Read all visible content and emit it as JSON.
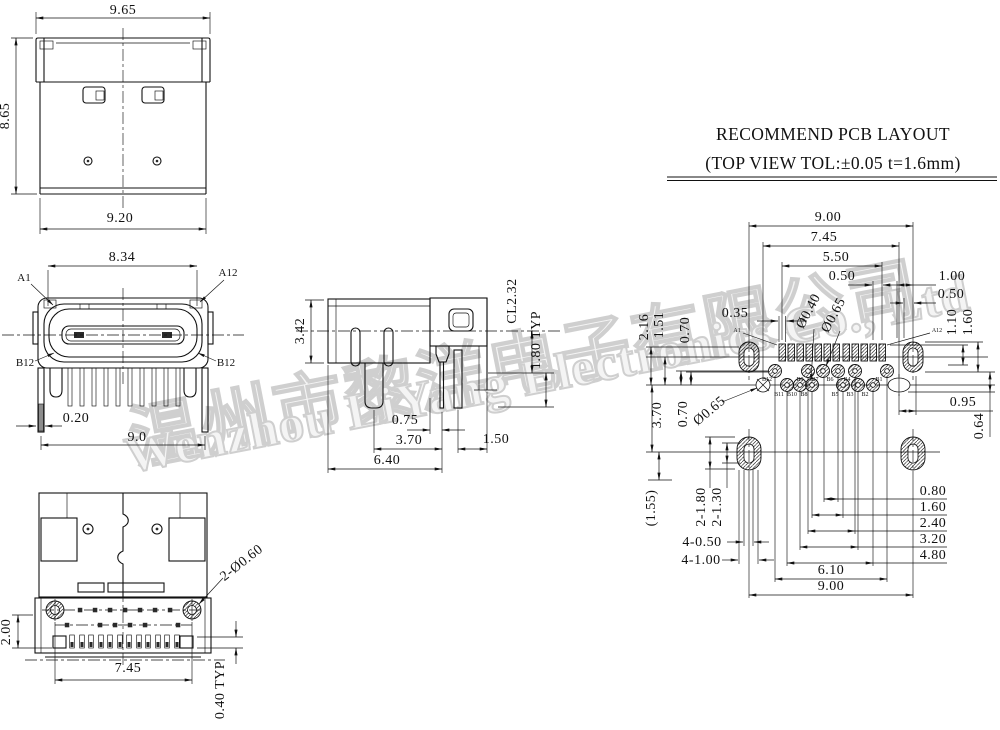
{
  "colors": {
    "line": "#111111",
    "watermark_stroke": "#cfcfcf"
  },
  "watermark": {
    "line1": "温州市黎洋电子有限公司",
    "line2": "Wenzhou LiYang Electronics Co., Ltd"
  },
  "pcb_title": {
    "line1": "RECOMMEND PCB LAYOUT",
    "line2": "(TOP VIEW TOL:±0.05 t=1.6mm)"
  },
  "top_view": {
    "width_top": "9.65",
    "height_left": "8.65",
    "width_bottom": "9.20"
  },
  "front_view": {
    "tongue_width": "8.34",
    "label_a1": "A1",
    "label_a12": "A12",
    "label_b12_left": "B12",
    "label_b12_right": "B12",
    "lead_thickness": "0.20",
    "body_width": "9.0"
  },
  "side_view": {
    "body_height": "3.42",
    "centerline_offset": "CL2.32",
    "lead_pitch": "1.80 TYP",
    "pin_offset": "0.75",
    "mid_span": "3.70",
    "tail_gap": "1.50",
    "overall_depth": "6.40"
  },
  "bottom_view": {
    "hole_callout": "2-Ø0.60",
    "flange_height": "2.00",
    "screw_span": "7.45",
    "pad_pitch": "0.40 TYP"
  },
  "pcb_layout": {
    "span_900_top": "9.00",
    "span_745": "7.45",
    "span_550": "5.50",
    "pad_pitch": "0.50",
    "right_100": "1.00",
    "right_050": "0.50",
    "left_216": "2.16",
    "left_151": "1.51",
    "left_070": "0.70",
    "pad_width": "0.35",
    "via_dia": "Ø0.40",
    "hole_dia": "Ø0.65",
    "label_a1": "A1",
    "label_a12": "A12",
    "right_110": "1.10",
    "right_160": "1.60",
    "mid_095": "0.95",
    "right_064": "0.64",
    "left_370": "3.70",
    "left_070b": "0.70",
    "hole_dia_b": "Ø0.65",
    "ref_155": "(1.55)",
    "slot_180": "2-1.80",
    "slot_130": "2-1.30",
    "slot_width": "4-0.50",
    "slot_height": "4-1.00",
    "sp_080": "0.80",
    "sp_160": "1.60",
    "sp_240": "2.40",
    "sp_320": "3.20",
    "sp_480": "4.80",
    "sp_610": "6.10",
    "span_900_bottom": "9.00",
    "pin_labels_top": [
      "B12",
      "B9",
      "B7",
      "B6",
      "B4",
      "B1"
    ],
    "pin_labels_bottom": [
      "B11",
      "B10",
      "B8",
      "B5",
      "B3",
      "B2"
    ]
  }
}
